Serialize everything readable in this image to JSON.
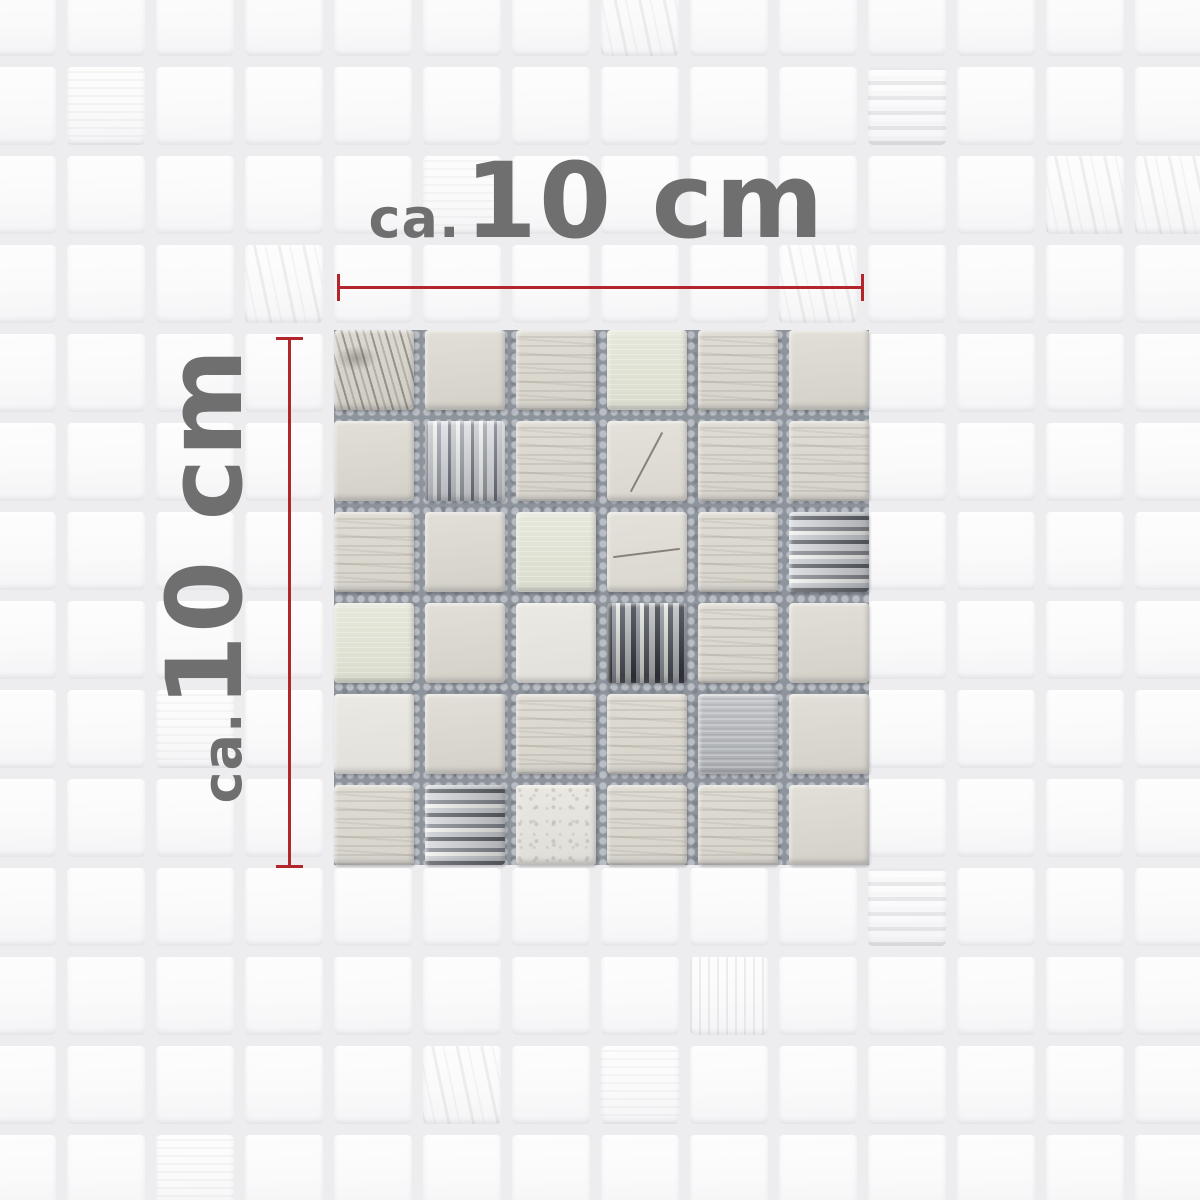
{
  "annotations": {
    "horizontal": {
      "prefix": "ca.",
      "value": "10 cm"
    },
    "vertical": {
      "prefix": "ca.",
      "value": "10 cm"
    },
    "line_color": "#b2262b",
    "text_color": "#6f6f6f"
  },
  "sample": {
    "rows": 6,
    "cols": 6,
    "grout_color": "#8e949c",
    "tiles": [
      [
        "marble",
        "stone",
        "stripes",
        "metal",
        "stripes",
        "stone"
      ],
      [
        "stone",
        "glassv",
        "stripes",
        "scratchd",
        "stripes",
        "stripes"
      ],
      [
        "stripes",
        "stone",
        "metal",
        "scratchh",
        "stripes",
        "glassh"
      ],
      [
        "metal",
        "stone",
        "white",
        "glassvd",
        "stripes",
        "stone"
      ],
      [
        "white",
        "stone",
        "stripes",
        "stripes",
        "metal2",
        "stone"
      ],
      [
        "stripes",
        "glassh",
        "speckle",
        "stripes",
        "stripes",
        "stone"
      ]
    ]
  },
  "background": {
    "tile_color": "#fbfbfc",
    "grout_color": "#ededf0",
    "grid": {
      "cols": 14,
      "rows": 14,
      "pitch": 89,
      "tile_size": 78,
      "offset": -22
    },
    "feature_tiles": [
      {
        "c": 7,
        "r": 0,
        "type": "streaks"
      },
      {
        "c": 1,
        "r": 1,
        "type": "grain"
      },
      {
        "c": 10,
        "r": 1,
        "type": "glass"
      },
      {
        "c": 5,
        "r": 2,
        "type": "grain"
      },
      {
        "c": 12,
        "r": 2,
        "type": "streaks"
      },
      {
        "c": 13,
        "r": 2,
        "type": "streaks"
      },
      {
        "c": 3,
        "r": 3,
        "type": "streaks"
      },
      {
        "c": 9,
        "r": 3,
        "type": "streaks"
      },
      {
        "c": 2,
        "r": 8,
        "type": "grain"
      },
      {
        "c": 10,
        "r": 10,
        "type": "glass"
      },
      {
        "c": 8,
        "r": 11,
        "type": "stripesv"
      },
      {
        "c": 7,
        "r": 12,
        "type": "grain"
      },
      {
        "c": 5,
        "r": 12,
        "type": "streaks"
      },
      {
        "c": 2,
        "r": 13,
        "type": "grain"
      }
    ]
  }
}
